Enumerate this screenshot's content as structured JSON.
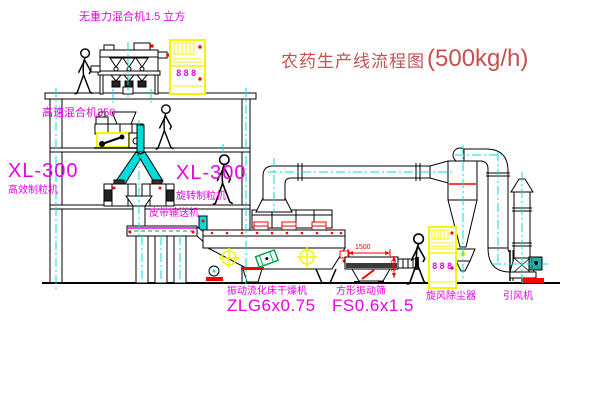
{
  "title": {
    "name": "农药生产线流程图",
    "capacity": "(500kg/h)"
  },
  "equipment_labels": {
    "gravity_free_mixer": "无重力混合机1.5 立方",
    "high_speed_mixer": "高速混合机350",
    "granulator_left_model": "XL-300",
    "granulator_left_name": "高效制粒机",
    "granulator_center_model": "XL-300",
    "granulator_center_name": "旋转制粒机",
    "belt_conveyor": "皮带输送机",
    "fluid_bed_dryer_name": "振动流化床干燥机",
    "fluid_bed_dryer_model": "ZLG6x0.75",
    "square_sieve_name": "方形振动筛",
    "square_sieve_model": "FS0.6x1.5",
    "cyclone_dust_collector": "旋风除尘器",
    "induced_draft_fan": "引风机"
  },
  "dimensions": {
    "sieve_length": "1500",
    "sieve_height": "541"
  },
  "control_cabinet": {
    "display": "888"
  },
  "colors": {
    "line_black": "#000000",
    "centerline_cyan": "#00dcdc",
    "label_magenta": "#e800e8",
    "alarm_red": "#ff0000",
    "cabinet_yellow": "#f5f500",
    "title_red": "#c45050",
    "belt_green": "#00a550",
    "fan_teal": "#2aa8a0"
  }
}
